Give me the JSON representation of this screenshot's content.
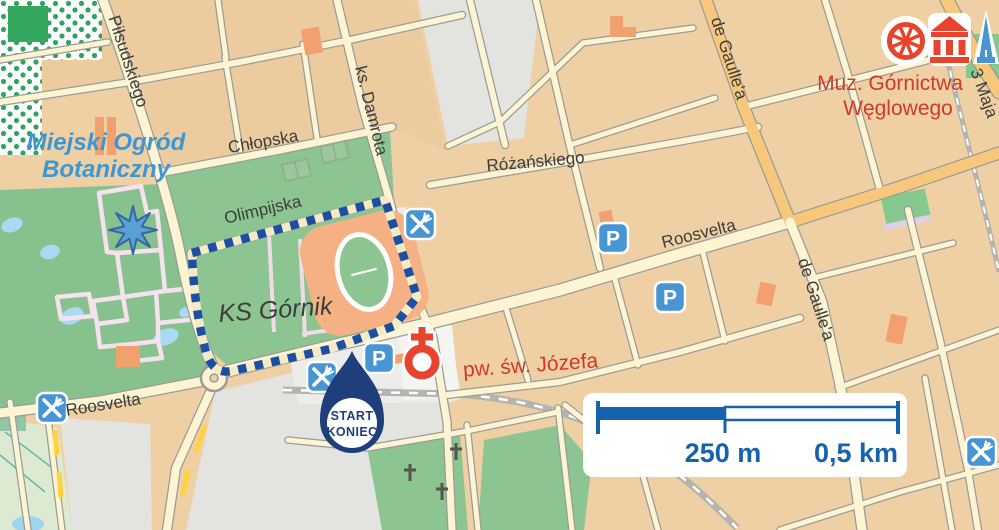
{
  "map": {
    "labels": {
      "pilsudskiego": "Piłsudskiego",
      "chlopska": "Chłopska",
      "olimpijska": "Olimpijska",
      "ks_damrota": "ks. Damrota",
      "rozanskiego": "Różańskiego",
      "roosvelta_center": "Roosvelta",
      "roosvelta_west": "Roosvelta",
      "de_gaullea_north": "de Gaulle'a",
      "de_gaullea_south": "de Gaulle'a",
      "trzy_maja": "3 Maja",
      "garden_line1": "Miejski Ogród",
      "garden_line2": "Botaniczny",
      "stadium": "KS Górnik",
      "church": "pw. św. Józefa",
      "museum_line1": "Muz. Górnictwa",
      "museum_line2": "Węglowego"
    },
    "start_marker": {
      "line1": "START",
      "line2": "KONIEC"
    },
    "scale_bar": {
      "mid_label": "250 m",
      "end_label": "0,5 km"
    },
    "icons": {
      "parking_letter": "P",
      "parking": "parking-icon",
      "restaurant": "restaurant-icon",
      "church_marker": "church-icon",
      "mining_wheel": "mining-wheel-icon",
      "museum_building": "museum-icon",
      "monument": "monument-icon"
    },
    "colors": {
      "route_blue": "#1c4fa1",
      "icon_blue": "#4795d2",
      "poi_red": "#e8432c",
      "label_red": "#d13a2a",
      "garden_label_blue": "#3e97d3",
      "scale_blue": "#1563ac",
      "marker_navy": "#1e3e7c"
    }
  }
}
